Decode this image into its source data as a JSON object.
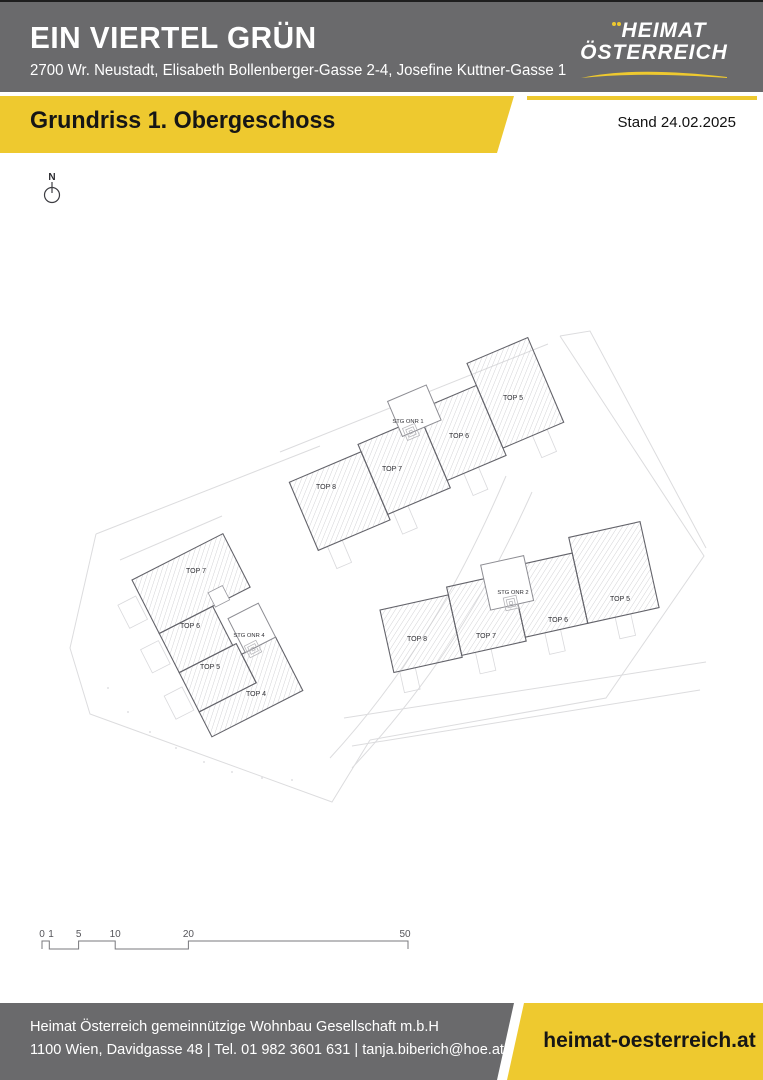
{
  "page": {
    "top_border_color": "#1e1e1e",
    "background": "#ffffff"
  },
  "header": {
    "bg_color": "#6a6a6c",
    "title": "EIN VIERTEL GRÜN",
    "address": "2700 Wr. Neustadt, Elisabeth Bollenberger-Gasse 2-4, Josefine Kuttner-Gasse 1",
    "logo": {
      "line1": "HEIMAT",
      "line2": "ÖSTERREICH",
      "accent_color": "#eec92f"
    }
  },
  "banner": {
    "bg_color": "#eec92f",
    "title": "Grundriss 1. Obergeschoss",
    "status_label": "Stand 24.02.2025"
  },
  "plan": {
    "north_label": "N",
    "buildings": [
      {
        "name": "Stiege 1",
        "stair_label": "STG ONR 1",
        "units": [
          {
            "label": "TOP 8"
          },
          {
            "label": "TOP 7"
          },
          {
            "label": "TOP 6"
          },
          {
            "label": "TOP 5"
          }
        ]
      },
      {
        "name": "Stiege 4",
        "stair_label": "STG ONR 4",
        "units": [
          {
            "label": "TOP 7"
          },
          {
            "label": "TOP 6"
          },
          {
            "label": "TOP 5"
          },
          {
            "label": "TOP 4"
          }
        ]
      },
      {
        "name": "Stiege 2",
        "stair_label": "STG ONR 2",
        "units": [
          {
            "label": "TOP 8"
          },
          {
            "label": "TOP 7"
          },
          {
            "label": "TOP 6"
          },
          {
            "label": "TOP 5"
          }
        ]
      }
    ],
    "scale_bar": {
      "labels": [
        "0",
        "1",
        "5",
        "10",
        "20",
        "50"
      ]
    }
  },
  "footer": {
    "bg_color": "#6a6a6c",
    "company_line1": "Heimat Österreich gemeinnützige Wohnbau Gesellschaft m.b.H",
    "company_line2": "1100 Wien, Davidgasse 48 | Tel. 01 982 3601 631 | tanja.biberich@hoe.at",
    "website": "heimat-oesterreich.at",
    "accent_color": "#eec92f"
  }
}
